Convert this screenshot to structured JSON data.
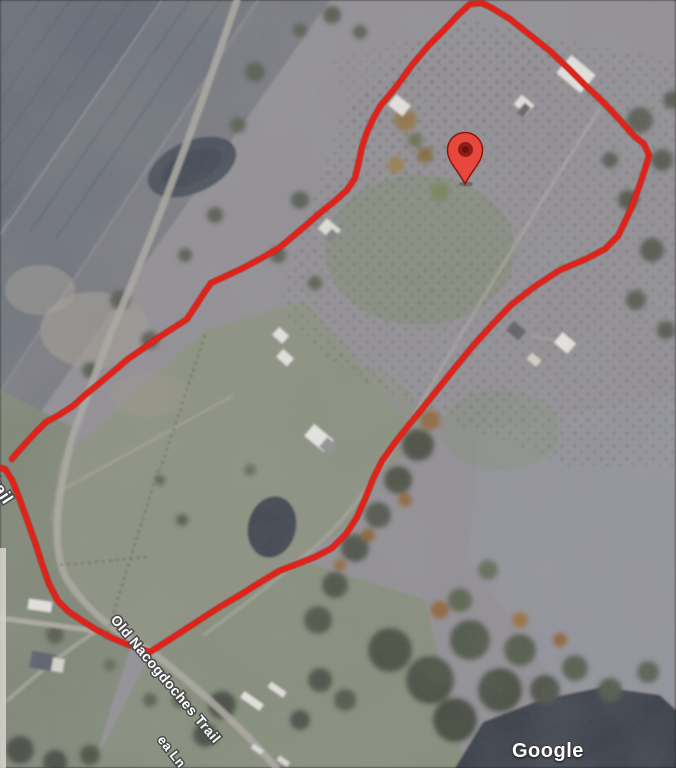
{
  "map": {
    "attribution": "Google",
    "labels": {
      "road_main": "Old Nacogdoches Trail",
      "road_partial": "Trail",
      "lane_partial": "ea Ln"
    },
    "label_style": {
      "fill": "#ffffff",
      "outline": "#4a4a4a"
    },
    "marker": {
      "name": "red-location-pin",
      "color": "#e8473d",
      "outline_color": "#87170e",
      "inner_color": "#8f1d13",
      "inner_core_color": "#6c120b",
      "x": 465,
      "y": 184
    },
    "boundary": {
      "color": "#e0231a",
      "shadow_color": "#8e130b",
      "stroke_width": 5.5,
      "main_points": [
        [
          -8,
          466
        ],
        [
          5,
          469
        ],
        [
          12,
          480
        ],
        [
          18,
          495
        ],
        [
          25,
          514
        ],
        [
          31,
          531
        ],
        [
          36,
          545
        ],
        [
          42,
          564
        ],
        [
          49,
          584
        ],
        [
          58,
          601
        ],
        [
          69,
          612
        ],
        [
          81,
          620
        ],
        [
          95,
          629
        ],
        [
          112,
          638
        ],
        [
          129,
          645
        ],
        [
          150,
          652
        ],
        [
          172,
          638
        ],
        [
          195,
          623
        ],
        [
          218,
          608
        ],
        [
          240,
          595
        ],
        [
          259,
          583
        ],
        [
          279,
          571
        ],
        [
          297,
          564
        ],
        [
          315,
          557
        ],
        [
          332,
          548
        ],
        [
          346,
          534
        ],
        [
          357,
          517
        ],
        [
          365,
          499
        ],
        [
          373,
          479
        ],
        [
          382,
          461
        ],
        [
          394,
          444
        ],
        [
          408,
          426
        ],
        [
          422,
          409
        ],
        [
          438,
          389
        ],
        [
          454,
          369
        ],
        [
          472,
          347
        ],
        [
          490,
          327
        ],
        [
          511,
          305
        ],
        [
          534,
          287
        ],
        [
          560,
          270
        ],
        [
          586,
          259
        ],
        [
          605,
          249
        ],
        [
          618,
          236
        ],
        [
          630,
          211
        ],
        [
          639,
          187
        ],
        [
          646,
          166
        ],
        [
          649,
          155
        ],
        [
          644,
          144
        ],
        [
          634,
          136
        ],
        [
          620,
          120
        ],
        [
          602,
          101
        ],
        [
          586,
          86
        ],
        [
          568,
          68
        ],
        [
          550,
          51
        ],
        [
          530,
          35
        ],
        [
          510,
          19
        ],
        [
          492,
          8
        ],
        [
          482,
          3
        ],
        [
          470,
          4
        ],
        [
          458,
          15
        ],
        [
          444,
          30
        ],
        [
          429,
          45
        ],
        [
          412,
          65
        ],
        [
          402,
          79
        ],
        [
          392,
          92
        ],
        [
          381,
          105
        ],
        [
          373,
          119
        ],
        [
          367,
          132
        ],
        [
          362,
          147
        ],
        [
          359,
          161
        ],
        [
          355,
          178
        ],
        [
          347,
          190
        ],
        [
          336,
          200
        ],
        [
          320,
          213
        ],
        [
          304,
          227
        ],
        [
          291,
          238
        ],
        [
          279,
          248
        ],
        [
          260,
          259
        ],
        [
          243,
          268
        ],
        [
          226,
          276
        ],
        [
          211,
          283
        ],
        [
          204,
          293
        ],
        [
          197,
          304
        ],
        [
          191,
          313
        ],
        [
          187,
          319
        ],
        [
          178,
          325
        ],
        [
          167,
          332
        ],
        [
          155,
          340
        ],
        [
          141,
          350
        ],
        [
          128,
          359
        ],
        [
          114,
          371
        ],
        [
          102,
          381
        ],
        [
          96,
          386
        ],
        [
          85,
          395
        ],
        [
          73,
          406
        ],
        [
          59,
          415
        ],
        [
          46,
          422
        ],
        [
          36,
          432
        ],
        [
          25,
          444
        ],
        [
          16,
          454
        ],
        [
          12,
          459
        ]
      ]
    }
  }
}
